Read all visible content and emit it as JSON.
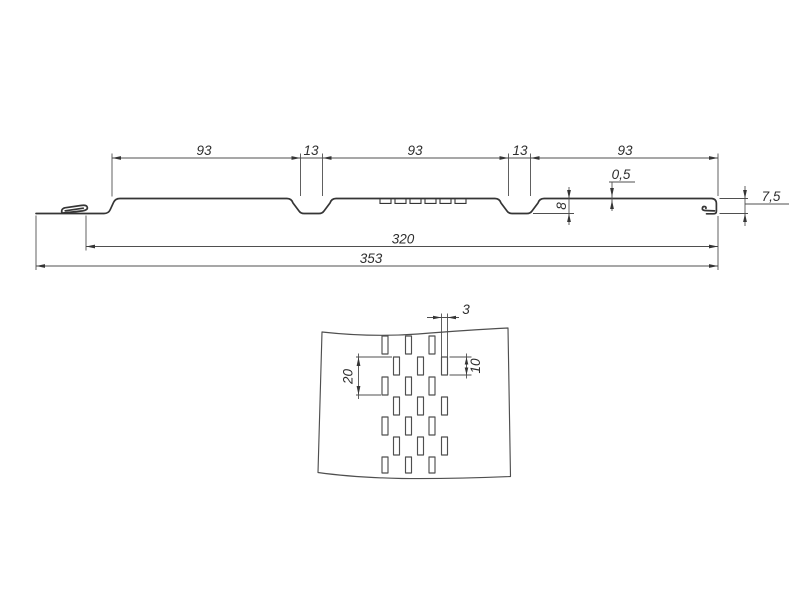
{
  "drawing": {
    "background": "#ffffff",
    "line_color": "#353535",
    "dim_color": "#4f4f4f",
    "profile_view": {
      "segment_dims": [
        "93",
        "13",
        "93",
        "13",
        "93"
      ],
      "width_to_lock": "320",
      "overall_width": "353",
      "thickness": "0,5",
      "groove_depth": "8",
      "edge_height": "7,5",
      "groove_count": 2,
      "edge_perforation_slot_count": 6
    },
    "detail_view": {
      "slot_width": "3",
      "slot_length": "10",
      "row_span": "20",
      "rows": 7,
      "slots_per_row": 3
    }
  }
}
